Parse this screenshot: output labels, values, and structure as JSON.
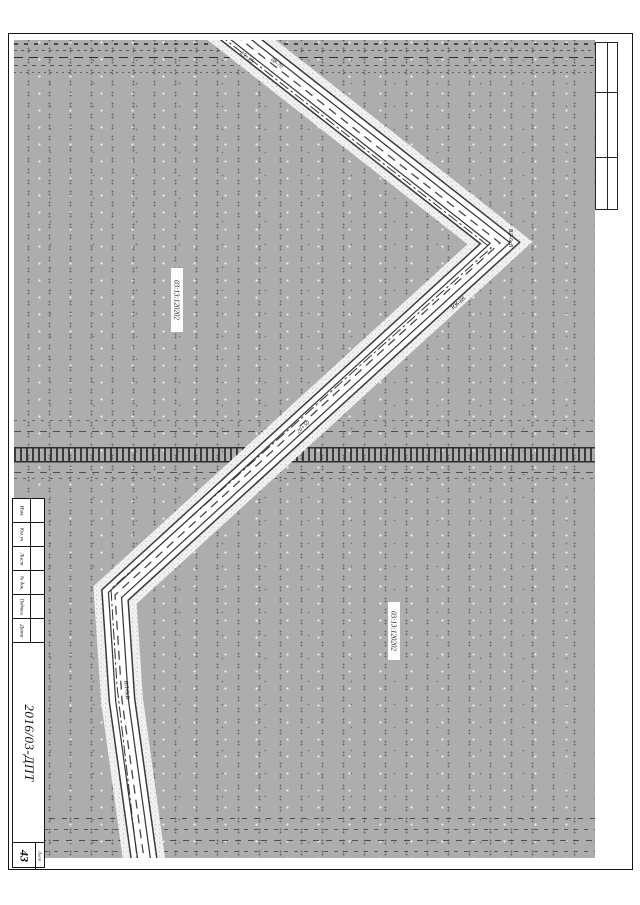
{
  "sheet": {
    "project_code": "2016/03-ДПТ",
    "sheet_label": "Лист",
    "sheet_number": "43",
    "revision_columns": [
      "Изм.",
      "Кол.уч.",
      "Лист",
      "№ док.",
      "Подпись",
      "Дата"
    ]
  },
  "map": {
    "cadastral_labels": [
      {
        "text": "03:13:120202"
      },
      {
        "text": "03:13:120202"
      }
    ],
    "road_labels": [
      {
        "text": "25+25"
      },
      {
        "text": "08-70"
      },
      {
        "text": "ВЛ-6кВ"
      },
      {
        "text": "Ю6-68"
      },
      {
        "text": "20+50"
      },
      {
        "text": "ВЛ-6кВ"
      }
    ]
  },
  "colors": {
    "field_gray": "#adadad",
    "line_dark": "#1a1a1a",
    "paper_white": "#ffffff",
    "road_fill": "#f2f2f2"
  }
}
